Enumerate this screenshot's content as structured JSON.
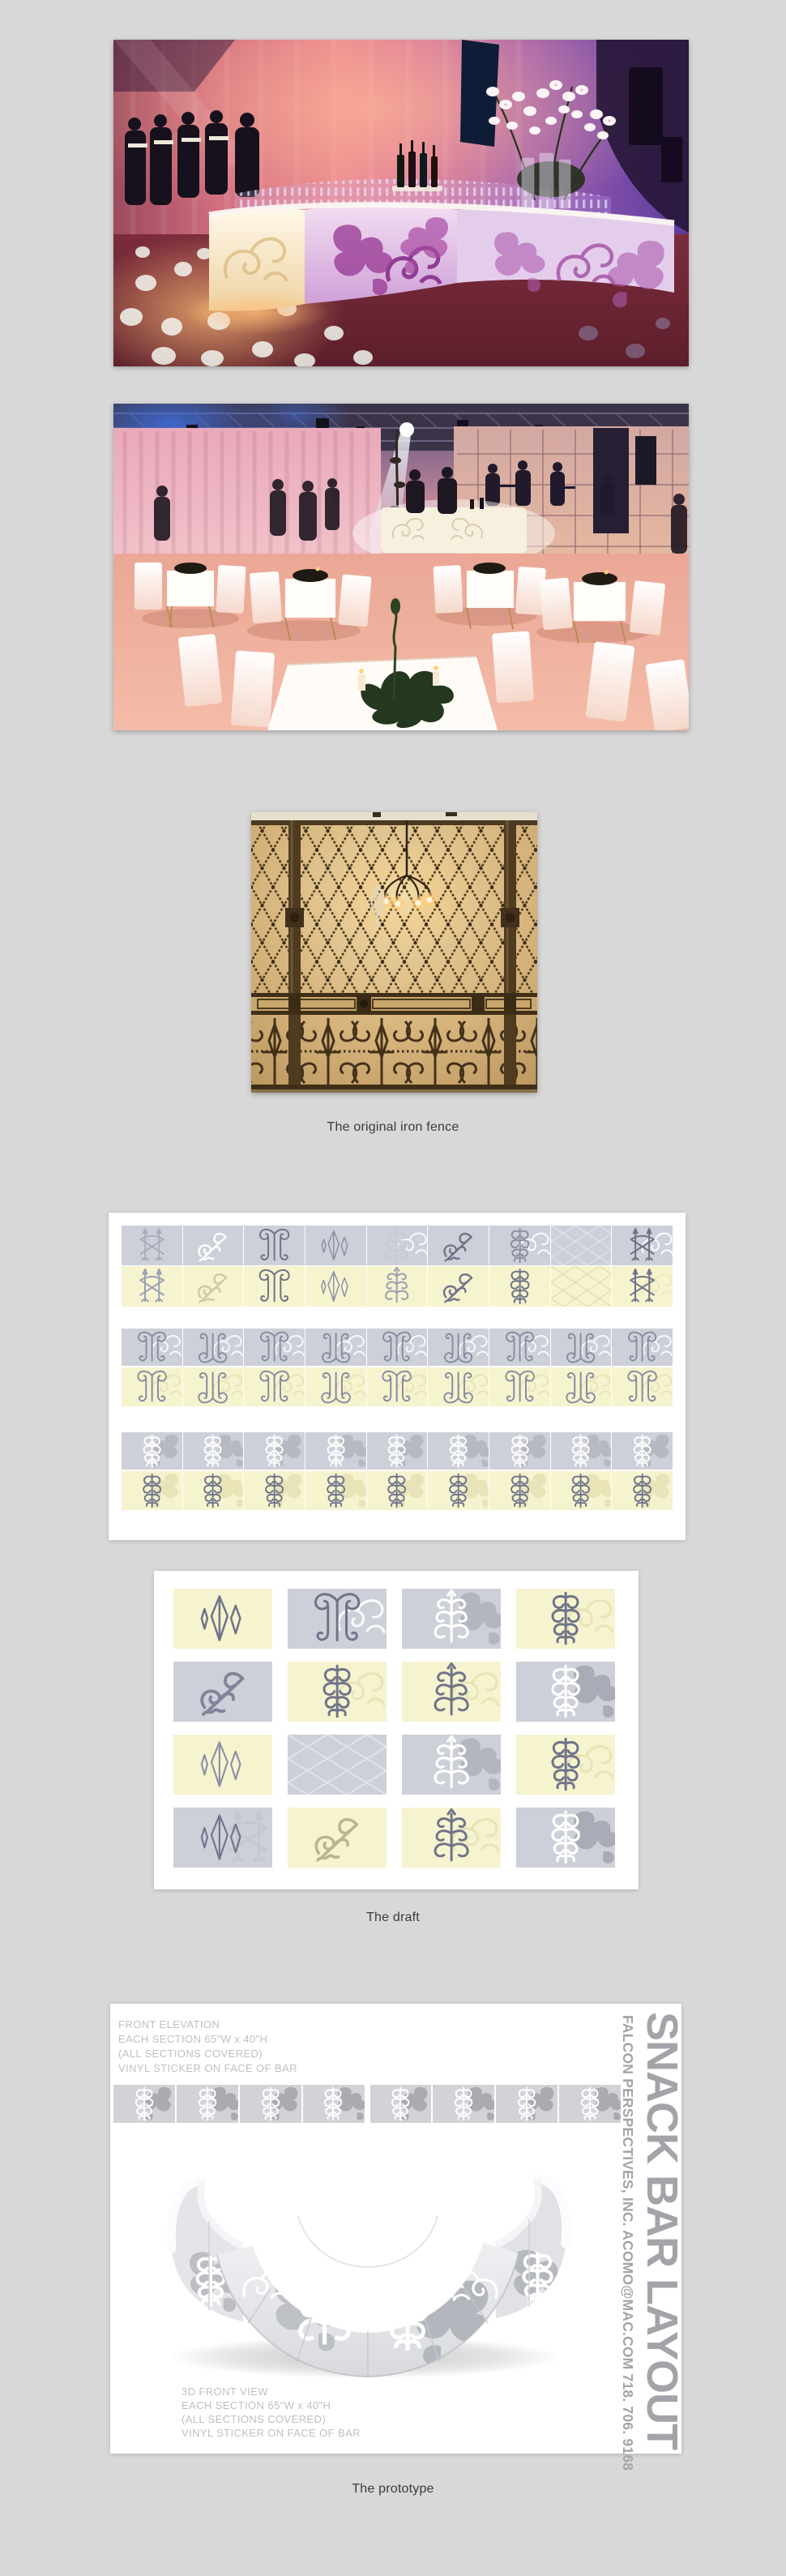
{
  "page": {
    "background": "#d8d8d8"
  },
  "captions": {
    "fence": "The original iron fence",
    "draft": "The draft",
    "prototype": "The prototype"
  },
  "photos": {
    "event_bar": {
      "description": "Curved white snack bar with damask vinyl pattern at an event, pink and purple uplighting, rows of glassware, white orchids, staff at left and gobo light dots on the floor"
    },
    "event_room": {
      "description": "Event room with white cocktail tables and chairs under salmon lighting, white drapes, truss ceiling with a spotlight beam, band on stage and a glowing bar at the back"
    }
  },
  "fence_photo": {
    "description": "Ornate iron fence with diamond lattice top, scrollwork base panels and a chandelier against a tan stone wall"
  },
  "draft": {
    "sheet1": {
      "rows": [
        {
          "bg": "g",
          "tiles": [
            {
              "m": "fence",
              "c": "#a9aebc"
            },
            {
              "m": "diag",
              "c": "#ffffff",
              "w": 5
            },
            {
              "m": "harp",
              "c": "#6f7489"
            },
            {
              "m": "kites",
              "c": "#8b90a4",
              "w": 3
            },
            {
              "m": "tree",
              "c": "#c6cad4",
              "u": {
                "m": "swirl",
                "c": "#ffffff",
                "o": 0.9
              }
            },
            {
              "m": "diag",
              "c": "#6f7489",
              "w": 5
            },
            {
              "m": "column",
              "c": "#8a8fa3",
              "u": {
                "m": "swirl",
                "c": "#ffffff",
                "o": 0.9
              }
            },
            {
              "m": "lattice",
              "c": "#e2e5ec",
              "wide": 1,
              "w": 2
            },
            {
              "m": "fence",
              "c": "#6f7489",
              "u": {
                "m": "swirl",
                "c": "#ffffff",
                "o": 0.9
              }
            }
          ]
        },
        {
          "bg": "y",
          "tiles": [
            {
              "m": "fence",
              "c": "#9aa0b2"
            },
            {
              "m": "diag",
              "c": "#cdc9a6",
              "w": 5
            },
            {
              "m": "harp",
              "c": "#6f7489"
            },
            {
              "m": "kites",
              "c": "#8b90a4",
              "w": 3
            },
            {
              "m": "tree",
              "c": "#9aa0b2"
            },
            {
              "m": "diag",
              "c": "#6f7489",
              "w": 5
            },
            {
              "m": "column",
              "c": "#6f7489"
            },
            {
              "m": "lattice",
              "c": "#dfdbaa",
              "wide": 1,
              "w": 2
            },
            {
              "m": "fence",
              "c": "#6f7489",
              "u": {
                "m": "swirl",
                "c": "#efeabc",
                "o": 1
              }
            }
          ]
        },
        {
          "bg": "g",
          "tiles": [
            {
              "m": "harp",
              "c": "#858a9e",
              "u": {
                "m": "swirl",
                "c": "#ffffff",
                "o": 0.85
              }
            },
            {
              "m": "harp",
              "c": "#858a9e",
              "flipY": 1,
              "u": {
                "m": "swirl",
                "c": "#ffffff",
                "o": 0.85
              }
            },
            {
              "m": "harp",
              "c": "#858a9e",
              "u": {
                "m": "swirl",
                "c": "#ffffff",
                "o": 0.85
              }
            },
            {
              "m": "harp",
              "c": "#858a9e",
              "flipY": 1,
              "u": {
                "m": "swirl",
                "c": "#ffffff",
                "o": 0.85
              }
            },
            {
              "m": "harp",
              "c": "#858a9e",
              "u": {
                "m": "swirl",
                "c": "#ffffff",
                "o": 0.85
              }
            },
            {
              "m": "harp",
              "c": "#858a9e",
              "flipY": 1,
              "u": {
                "m": "swirl",
                "c": "#ffffff",
                "o": 0.85
              }
            },
            {
              "m": "harp",
              "c": "#858a9e",
              "u": {
                "m": "swirl",
                "c": "#ffffff",
                "o": 0.85
              }
            },
            {
              "m": "harp",
              "c": "#858a9e",
              "flipY": 1,
              "u": {
                "m": "swirl",
                "c": "#ffffff",
                "o": 0.85
              }
            },
            {
              "m": "harp",
              "c": "#858a9e",
              "u": {
                "m": "swirl",
                "c": "#ffffff",
                "o": 0.85
              }
            }
          ]
        },
        {
          "bg": "y",
          "tiles": [
            {
              "m": "harp",
              "c": "#858a9e",
              "u": {
                "m": "swirl",
                "c": "#e9e4b8",
                "o": 1
              }
            },
            {
              "m": "harp",
              "c": "#858a9e",
              "flipY": 1,
              "u": {
                "m": "swirl",
                "c": "#e9e4b8",
                "o": 1
              }
            },
            {
              "m": "harp",
              "c": "#858a9e",
              "u": {
                "m": "swirl",
                "c": "#e9e4b8",
                "o": 1
              }
            },
            {
              "m": "harp",
              "c": "#858a9e",
              "flipY": 1,
              "u": {
                "m": "swirl",
                "c": "#e9e4b8",
                "o": 1
              }
            },
            {
              "m": "harp",
              "c": "#858a9e",
              "u": {
                "m": "swirl",
                "c": "#e9e4b8",
                "o": 1
              }
            },
            {
              "m": "harp",
              "c": "#858a9e",
              "flipY": 1,
              "u": {
                "m": "swirl",
                "c": "#e9e4b8",
                "o": 1
              }
            },
            {
              "m": "harp",
              "c": "#858a9e",
              "u": {
                "m": "swirl",
                "c": "#e9e4b8",
                "o": 1
              }
            },
            {
              "m": "harp",
              "c": "#858a9e",
              "flipY": 1,
              "u": {
                "m": "swirl",
                "c": "#e9e4b8",
                "o": 1
              }
            },
            {
              "m": "harp",
              "c": "#858a9e",
              "u": {
                "m": "swirl",
                "c": "#e9e4b8",
                "o": 1
              }
            }
          ]
        },
        {
          "bg": "g",
          "tiles": [
            {
              "m": "column",
              "c": "#ffffff",
              "w": 4.5,
              "u": {
                "m": "blob",
                "c": "#b6b9c2",
                "fill": 1,
                "flip": 1
              }
            },
            {
              "m": "column",
              "c": "#ffffff",
              "w": 4.5,
              "flip": 1,
              "u": {
                "m": "blob",
                "c": "#b6b9c2",
                "fill": 1
              }
            },
            {
              "m": "column",
              "c": "#ffffff",
              "w": 4.5,
              "u": {
                "m": "blob",
                "c": "#b6b9c2",
                "fill": 1,
                "flip": 1
              }
            },
            {
              "m": "column",
              "c": "#ffffff",
              "w": 4.5,
              "flip": 1,
              "u": {
                "m": "blob",
                "c": "#b6b9c2",
                "fill": 1
              }
            },
            {
              "m": "column",
              "c": "#ffffff",
              "w": 4.5,
              "u": {
                "m": "blob",
                "c": "#b6b9c2",
                "fill": 1,
                "flip": 1
              }
            },
            {
              "m": "column",
              "c": "#ffffff",
              "w": 4.5,
              "flip": 1,
              "u": {
                "m": "blob",
                "c": "#b6b9c2",
                "fill": 1
              }
            },
            {
              "m": "column",
              "c": "#ffffff",
              "w": 4.5,
              "u": {
                "m": "blob",
                "c": "#b6b9c2",
                "fill": 1,
                "flip": 1
              }
            },
            {
              "m": "column",
              "c": "#ffffff",
              "w": 4.5,
              "flip": 1,
              "u": {
                "m": "blob",
                "c": "#b6b9c2",
                "fill": 1
              }
            },
            {
              "m": "column",
              "c": "#ffffff",
              "w": 4.5,
              "u": {
                "m": "blob",
                "c": "#b6b9c2",
                "fill": 1,
                "flip": 1
              }
            }
          ]
        },
        {
          "bg": "y",
          "tiles": [
            {
              "m": "column",
              "c": "#6f7489",
              "u": {
                "m": "blob",
                "c": "#e9e4b8",
                "fill": 1,
                "flip": 1
              }
            },
            {
              "m": "column",
              "c": "#6f7489",
              "flip": 1,
              "u": {
                "m": "blob",
                "c": "#e9e4b8",
                "fill": 1
              }
            },
            {
              "m": "column",
              "c": "#6f7489",
              "u": {
                "m": "blob",
                "c": "#e9e4b8",
                "fill": 1,
                "flip": 1
              }
            },
            {
              "m": "column",
              "c": "#6f7489",
              "flip": 1,
              "u": {
                "m": "blob",
                "c": "#e9e4b8",
                "fill": 1
              }
            },
            {
              "m": "column",
              "c": "#6f7489",
              "u": {
                "m": "blob",
                "c": "#e9e4b8",
                "fill": 1,
                "flip": 1
              }
            },
            {
              "m": "column",
              "c": "#6f7489",
              "flip": 1,
              "u": {
                "m": "blob",
                "c": "#e9e4b8",
                "fill": 1
              }
            },
            {
              "m": "column",
              "c": "#6f7489",
              "u": {
                "m": "blob",
                "c": "#e9e4b8",
                "fill": 1,
                "flip": 1
              }
            },
            {
              "m": "column",
              "c": "#6f7489",
              "flip": 1,
              "u": {
                "m": "blob",
                "c": "#e9e4b8",
                "fill": 1
              }
            },
            {
              "m": "column",
              "c": "#6f7489",
              "u": {
                "m": "blob",
                "c": "#e9e4b8",
                "fill": 1,
                "flip": 1
              }
            }
          ]
        }
      ]
    },
    "sheet2": {
      "rows": [
        [
          {
            "bg": "y",
            "m": "kites",
            "c": "#6f7489",
            "w": 3.5
          },
          {
            "bg": "g",
            "m": "harp",
            "c": "#6f7489",
            "u": {
              "m": "swirl",
              "c": "#ffffff",
              "o": 0.9
            }
          },
          {
            "bg": "g",
            "m": "tree",
            "c": "#ffffff",
            "w": 4.5,
            "u": {
              "m": "blob",
              "c": "#b3b6bf",
              "fill": 1
            }
          },
          {
            "bg": "y",
            "m": "column",
            "c": "#6f7489",
            "u": {
              "m": "swirl",
              "c": "#e9e4b8",
              "o": 1
            }
          }
        ],
        [
          {
            "bg": "g",
            "m": "diag",
            "c": "#80859a",
            "w": 5.5
          },
          {
            "bg": "y",
            "m": "column",
            "c": "#6f7489",
            "u": {
              "m": "swirl",
              "c": "#e9e4b8",
              "o": 1
            }
          },
          {
            "bg": "y",
            "m": "tree",
            "c": "#6f7489",
            "u": {
              "m": "swirl",
              "c": "#e9e4b8",
              "o": 1
            }
          },
          {
            "bg": "g",
            "m": "column",
            "c": "#ffffff",
            "w": 4.5,
            "u": {
              "m": "blob",
              "c": "#a9acb6",
              "fill": 1
            }
          }
        ],
        [
          {
            "bg": "y",
            "m": "kites",
            "c": "#8b90a4",
            "w": 3
          },
          {
            "bg": "g",
            "m": "lattice",
            "c": "#e2e5ec",
            "wide": 1,
            "w": 2
          },
          {
            "bg": "g",
            "m": "tree",
            "c": "#ffffff",
            "w": 4.5,
            "u": {
              "m": "blob",
              "c": "#b3b6bf",
              "fill": 1
            }
          },
          {
            "bg": "y",
            "m": "column",
            "c": "#6f7489",
            "u": {
              "m": "swirl",
              "c": "#e9e4b8",
              "o": 1
            }
          }
        ],
        [
          {
            "bg": "g",
            "m": "kites",
            "c": "#6f7489",
            "w": 3,
            "u": {
              "m": "fence",
              "c": "#c3c7d1"
            }
          },
          {
            "bg": "y",
            "m": "diag",
            "c": "#b9b593",
            "w": 5
          },
          {
            "bg": "y",
            "m": "tree",
            "c": "#6f7489",
            "u": {
              "m": "swirl",
              "c": "#e9e4b8",
              "o": 1
            }
          },
          {
            "bg": "g",
            "m": "column",
            "c": "#ffffff",
            "w": 4.5,
            "u": {
              "m": "blob",
              "c": "#a9acb6",
              "fill": 1
            }
          }
        ]
      ]
    }
  },
  "prototype": {
    "front_note": [
      "FRONT ELEVATION",
      "EACH SECTION 65\"W x 40\"H",
      "(ALL SECTIONS COVERED)",
      "VINYL STICKER ON FACE OF BAR"
    ],
    "view_note": [
      "3D FRONT VIEW",
      "EACH SECTION 65\"W x 40\"H",
      "(ALL SECTIONS COVERED)",
      "VINYL STICKER ON FACE OF BAR"
    ],
    "title_vertical": "SNACK BAR LAYOUT",
    "contact_vertical": "FALCON PERSPECTIVES, INC. ACOMO@MAC.COM 718. 706. 9168",
    "strip": {
      "sections": 8,
      "tiles": [
        {
          "bg": "s",
          "m": "column",
          "c": "#ffffff",
          "w": 4.5,
          "u": {
            "m": "blob",
            "c": "#a9abb1",
            "fill": 1,
            "flip": 1
          }
        },
        {
          "bg": "s",
          "m": "column",
          "c": "#ffffff",
          "w": 4.5,
          "flip": 1,
          "u": {
            "m": "blob",
            "c": "#a9abb1",
            "fill": 1
          }
        },
        {
          "bg": "s",
          "m": "column",
          "c": "#ffffff",
          "w": 4.5,
          "u": {
            "m": "blob",
            "c": "#a9abb1",
            "fill": 1,
            "flip": 1
          }
        },
        {
          "bg": "s",
          "m": "column",
          "c": "#ffffff",
          "w": 4.5,
          "flip": 1,
          "u": {
            "m": "blob",
            "c": "#a9abb1",
            "fill": 1
          }
        },
        {
          "bg": "s",
          "m": "column",
          "c": "#ffffff",
          "w": 4.5,
          "u": {
            "m": "blob",
            "c": "#a9abb1",
            "fill": 1,
            "flip": 1
          }
        },
        {
          "bg": "s",
          "m": "column",
          "c": "#ffffff",
          "w": 4.5,
          "flip": 1,
          "u": {
            "m": "blob",
            "c": "#a9abb1",
            "fill": 1
          }
        },
        {
          "bg": "s",
          "m": "column",
          "c": "#ffffff",
          "w": 4.5,
          "u": {
            "m": "blob",
            "c": "#a9abb1",
            "fill": 1,
            "flip": 1
          }
        },
        {
          "bg": "s",
          "m": "column",
          "c": "#ffffff",
          "w": 4.5,
          "flip": 1,
          "u": {
            "m": "blob",
            "c": "#a9abb1",
            "fill": 1
          }
        }
      ]
    }
  },
  "palette": {
    "tile_gray": "#cdd0d8",
    "tile_yellow": "#f6f3cf",
    "motif_dark": "#6f7489",
    "motif_white": "#ffffff",
    "sheet": "#ffffff",
    "caption_text": "#3b3b3b",
    "proto_note_text": "#bdc0c4",
    "proto_title_text": "#a2a4a9"
  }
}
